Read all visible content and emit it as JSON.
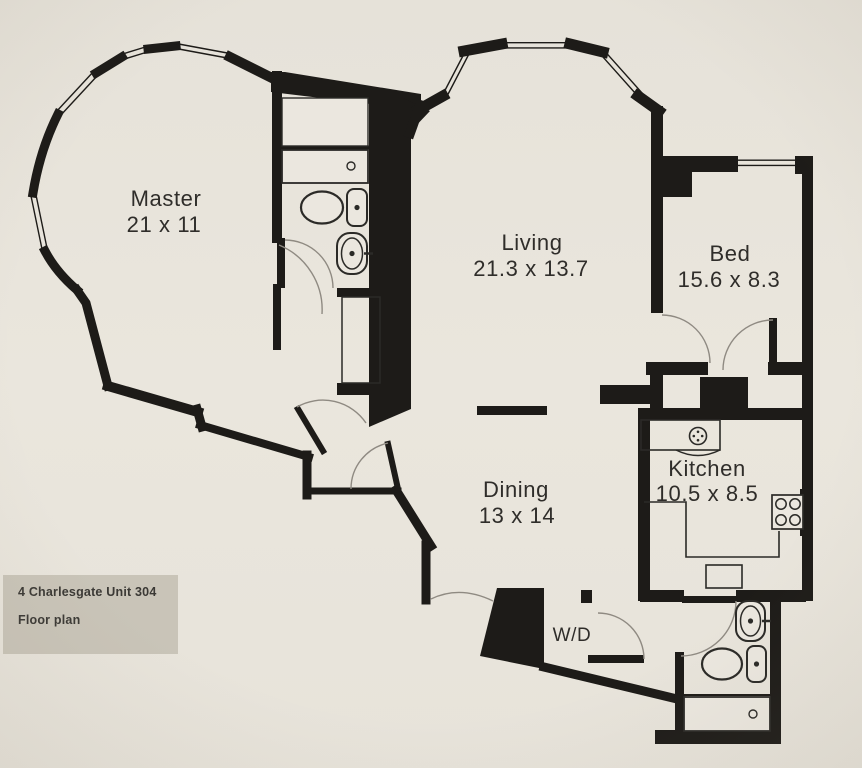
{
  "footer": {
    "line1": "4 Charlesgate Unit 304",
    "line2": "Floor plan"
  },
  "rooms": {
    "master": {
      "name": "Master",
      "dims": "21 x 11"
    },
    "living": {
      "name": "Living",
      "dims": "21.3 x 13.7"
    },
    "bed": {
      "name": "Bed",
      "dims": "15.6 x 8.3"
    },
    "kitchen": {
      "name": "Kitchen",
      "dims": "10.5 x 8.5"
    },
    "dining": {
      "name": "Dining",
      "dims": "13 x 14"
    },
    "laundry": {
      "label": "W/D"
    }
  },
  "fixtures": {
    "bathroom_top": [
      "bathtub",
      "toilet",
      "sink",
      "closet"
    ],
    "bathroom_bottom": [
      "sink",
      "toilet",
      "bathtub"
    ],
    "kitchen": [
      "kitchen-sink",
      "dishwasher",
      "counter",
      "island",
      "stove"
    ]
  },
  "colors": {
    "background": "#e8e4db",
    "wall": "#1d1b18",
    "label_box": "#c9c4b8",
    "text": "#2f2d2a",
    "door_arc": "#8f8a82"
  }
}
